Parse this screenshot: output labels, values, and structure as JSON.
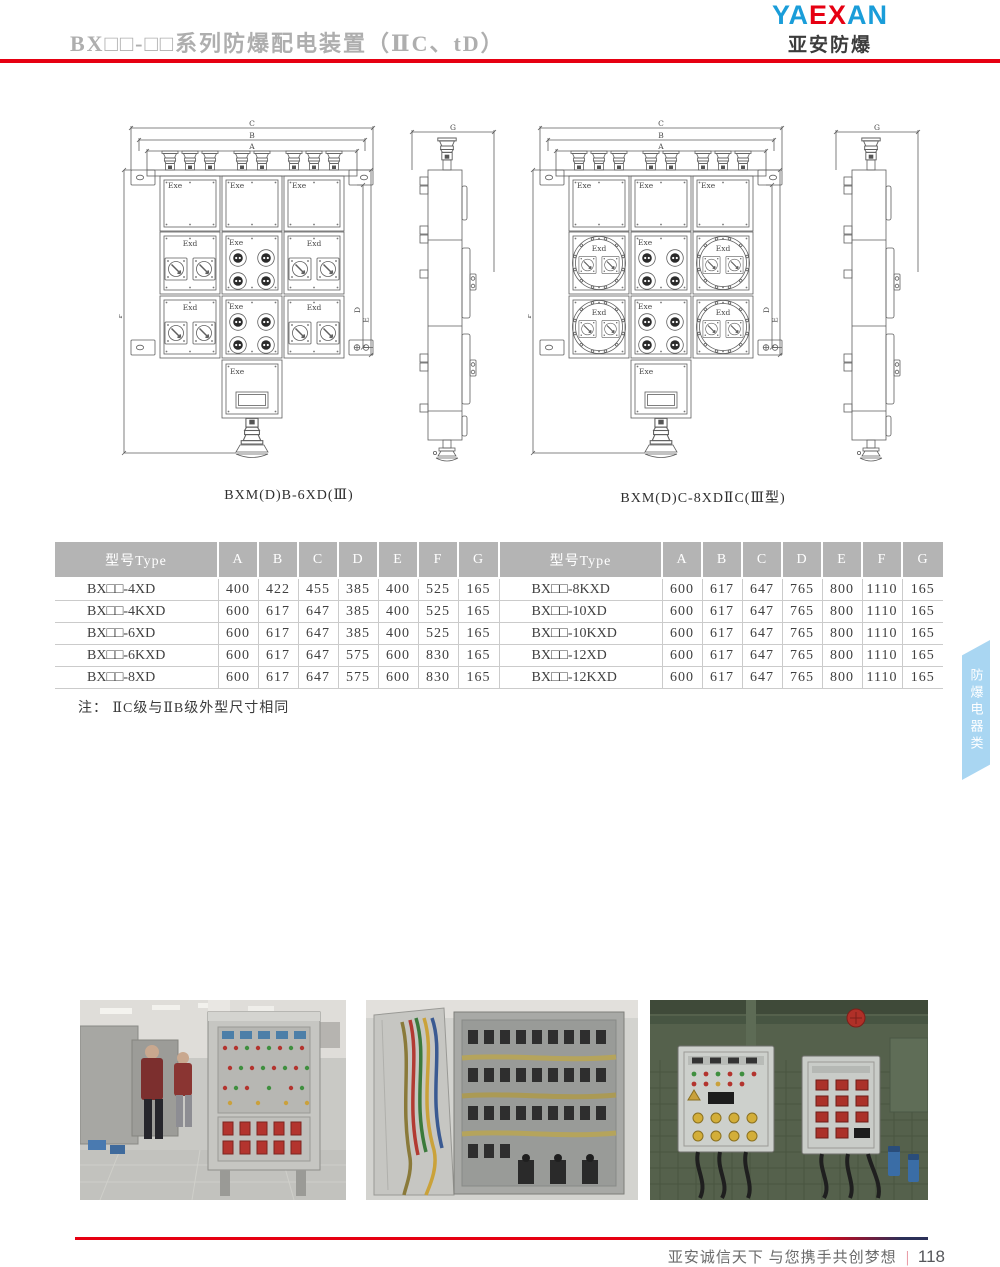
{
  "header": {
    "title": "BX□□-□□系列防爆配电装置（ⅡC、tD）",
    "logo": {
      "part1": "YA",
      "part2": "EX",
      "part3": "AN",
      "subtitle": "亚安防爆"
    }
  },
  "diagrams": {
    "left": {
      "caption": "BXM(D)B-6XD(Ⅲ)"
    },
    "right": {
      "caption": "BXM(D)C-8XDⅡC(Ⅲ型)"
    },
    "labels": {
      "A": "A",
      "B": "B",
      "C": "C",
      "D": "D",
      "E": "E",
      "F": "F",
      "G": "G",
      "exe": "Exe",
      "exd": "Exd"
    }
  },
  "table": {
    "columns": [
      "型号Type",
      "A",
      "B",
      "C",
      "D",
      "E",
      "F",
      "G"
    ],
    "left_rows": [
      {
        "model": "BX□□-4XD",
        "values": [
          "400",
          "422",
          "455",
          "385",
          "400",
          "525",
          "165"
        ]
      },
      {
        "model": "BX□□-4KXD",
        "values": [
          "600",
          "617",
          "647",
          "385",
          "400",
          "525",
          "165"
        ]
      },
      {
        "model": "BX□□-6XD",
        "values": [
          "600",
          "617",
          "647",
          "385",
          "400",
          "525",
          "165"
        ]
      },
      {
        "model": "BX□□-6KXD",
        "values": [
          "600",
          "617",
          "647",
          "575",
          "600",
          "830",
          "165"
        ]
      },
      {
        "model": "BX□□-8XD",
        "values": [
          "600",
          "617",
          "647",
          "575",
          "600",
          "830",
          "165"
        ]
      }
    ],
    "right_rows": [
      {
        "model": "BX□□-8KXD",
        "values": [
          "600",
          "617",
          "647",
          "765",
          "800",
          "1110",
          "165"
        ]
      },
      {
        "model": "BX□□-10XD",
        "values": [
          "600",
          "617",
          "647",
          "765",
          "800",
          "1110",
          "165"
        ]
      },
      {
        "model": "BX□□-10KXD",
        "values": [
          "600",
          "617",
          "647",
          "765",
          "800",
          "1110",
          "165"
        ]
      },
      {
        "model": "BX□□-12XD",
        "values": [
          "600",
          "617",
          "647",
          "765",
          "800",
          "1110",
          "165"
        ]
      },
      {
        "model": "BX□□-12KXD",
        "values": [
          "600",
          "617",
          "647",
          "765",
          "800",
          "1110",
          "165"
        ]
      }
    ]
  },
  "note": "注： ⅡC级与ⅡB级外型尺寸相同",
  "side_tab": {
    "label": "防爆电器类"
  },
  "photos": [
    {
      "name": "workshop-assembly-photo"
    },
    {
      "name": "wired-cabinet-interior-photo"
    },
    {
      "name": "site-installed-control-boxes-photo"
    }
  ],
  "footer": {
    "slogan": "亚安诚信天下 与您携手共创梦想",
    "divider": "|",
    "page": "118"
  },
  "colors": {
    "accent_red": "#e60012",
    "logo_blue": "#1a9dd9",
    "table_header_bg": "#b4b4b4",
    "side_tab_bg": "#a9d6f2",
    "footer_navy": "#2b3058"
  }
}
